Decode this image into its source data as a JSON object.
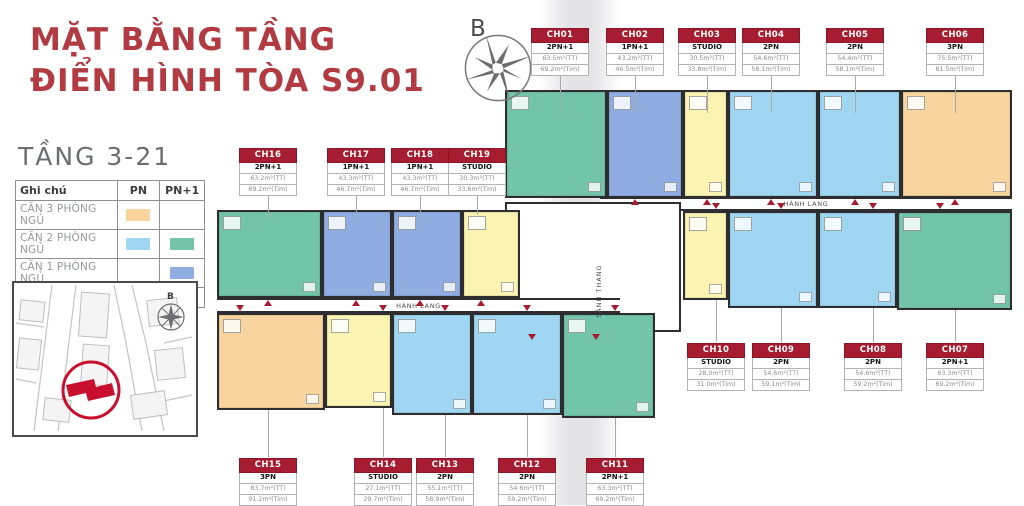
{
  "title": {
    "line1": "MẶT BẰNG TẦNG",
    "line2": "ĐIỂN HÌNH TÒA S9.01"
  },
  "subtitle": "TẦNG 3-21",
  "compass": {
    "label": "B"
  },
  "sitemap_compass_label": "B",
  "legend": {
    "header_note": "Ghi chú",
    "header_pn": "PN",
    "header_pn1": "PN+1",
    "rows": [
      {
        "label": "CĂN 3 PHÒNG NGỦ",
        "pn_color": "#F8D49E",
        "pn1_color": ""
      },
      {
        "label": "CĂN 2 PHÒNG NGỦ",
        "pn_color": "#9FD7F2",
        "pn1_color": "#72C5A8"
      },
      {
        "label": "CĂN 1 PHÒNG NGỦ",
        "pn_color": "",
        "pn1_color": "#8FADE0"
      },
      {
        "label": "CĂN STUDIO",
        "pn_color": "#FAF3B2",
        "pn1_color": ""
      }
    ]
  },
  "colors": {
    "accent_red": "#B23A41",
    "label_red": "#A61C30",
    "type_3pn": "#F8D49E",
    "type_2pn": "#9FD7F2",
    "type_2pn1": "#72C5A8",
    "type_1pn1": "#8FADE0",
    "type_studio": "#FAF3B2"
  },
  "plan": {
    "corridor_label": "HÀNH LANG",
    "core_label": "SẢNH THANG",
    "units": [
      {
        "id": "CH01",
        "type": "2PN+1",
        "area_tt": "63.5m²(TT)",
        "area_tim": "69.2m²(Tim)",
        "color": "#72C5A8"
      },
      {
        "id": "CH02",
        "type": "1PN+1",
        "area_tt": "43.2m²(TT)",
        "area_tim": "46.5m²(Tim)",
        "color": "#8FADE0"
      },
      {
        "id": "CH03",
        "type": "STUDIO",
        "area_tt": "30.5m²(TT)",
        "area_tim": "33.8m²(Tim)",
        "color": "#FAF3B2"
      },
      {
        "id": "CH04",
        "type": "2PN",
        "area_tt": "54.6m²(TT)",
        "area_tim": "58.1m²(Tim)",
        "color": "#9FD7F2"
      },
      {
        "id": "CH05",
        "type": "2PN",
        "area_tt": "54.4m²(TT)",
        "area_tim": "58.1m²(Tim)",
        "color": "#9FD7F2"
      },
      {
        "id": "CH06",
        "type": "3PN",
        "area_tt": "75.5m²(TT)",
        "area_tim": "81.5m²(Tim)",
        "color": "#F8D49E"
      },
      {
        "id": "CH07",
        "type": "2PN+1",
        "area_tt": "63.3m²(TT)",
        "area_tim": "69.2m²(Tim)",
        "color": "#72C5A8"
      },
      {
        "id": "CH08",
        "type": "2PN",
        "area_tt": "54.6m²(TT)",
        "area_tim": "59.2m²(Tim)",
        "color": "#9FD7F2"
      },
      {
        "id": "CH09",
        "type": "2PN",
        "area_tt": "54.6m²(TT)",
        "area_tim": "59.1m²(Tim)",
        "color": "#9FD7F2"
      },
      {
        "id": "CH10",
        "type": "STUDIO",
        "area_tt": "28.0m²(TT)",
        "area_tim": "31.0m²(Tim)",
        "color": "#FAF3B2"
      },
      {
        "id": "CH11",
        "type": "2PN+1",
        "area_tt": "63.3m²(TT)",
        "area_tim": "69.2m²(Tim)",
        "color": "#72C5A8"
      },
      {
        "id": "CH12",
        "type": "2PN",
        "area_tt": "54.6m²(TT)",
        "area_tim": "59.2m²(Tim)",
        "color": "#9FD7F2"
      },
      {
        "id": "CH13",
        "type": "2PN",
        "area_tt": "55.1m²(TT)",
        "area_tim": "58.9m²(Tim)",
        "color": "#9FD7F2"
      },
      {
        "id": "CH14",
        "type": "STUDIO",
        "area_tt": "27.1m²(TT)",
        "area_tim": "29.7m²(Tim)",
        "color": "#FAF3B2"
      },
      {
        "id": "CH15",
        "type": "3PN",
        "area_tt": "83.7m²(TT)",
        "area_tim": "91.2m²(Tim)",
        "color": "#F8D49E"
      },
      {
        "id": "CH16",
        "type": "2PN+1",
        "area_tt": "63.2m²(TT)",
        "area_tim": "69.2m²(Tim)",
        "color": "#72C5A8"
      },
      {
        "id": "CH17",
        "type": "1PN+1",
        "area_tt": "43.3m²(TT)",
        "area_tim": "46.7m²(Tim)",
        "color": "#8FADE0"
      },
      {
        "id": "CH18",
        "type": "1PN+1",
        "area_tt": "43.3m²(TT)",
        "area_tim": "46.7m²(Tim)",
        "color": "#8FADE0"
      },
      {
        "id": "CH19",
        "type": "STUDIO",
        "area_tt": "30.3m²(TT)",
        "area_tim": "33.6m²(Tim)",
        "color": "#FAF3B2"
      }
    ]
  }
}
